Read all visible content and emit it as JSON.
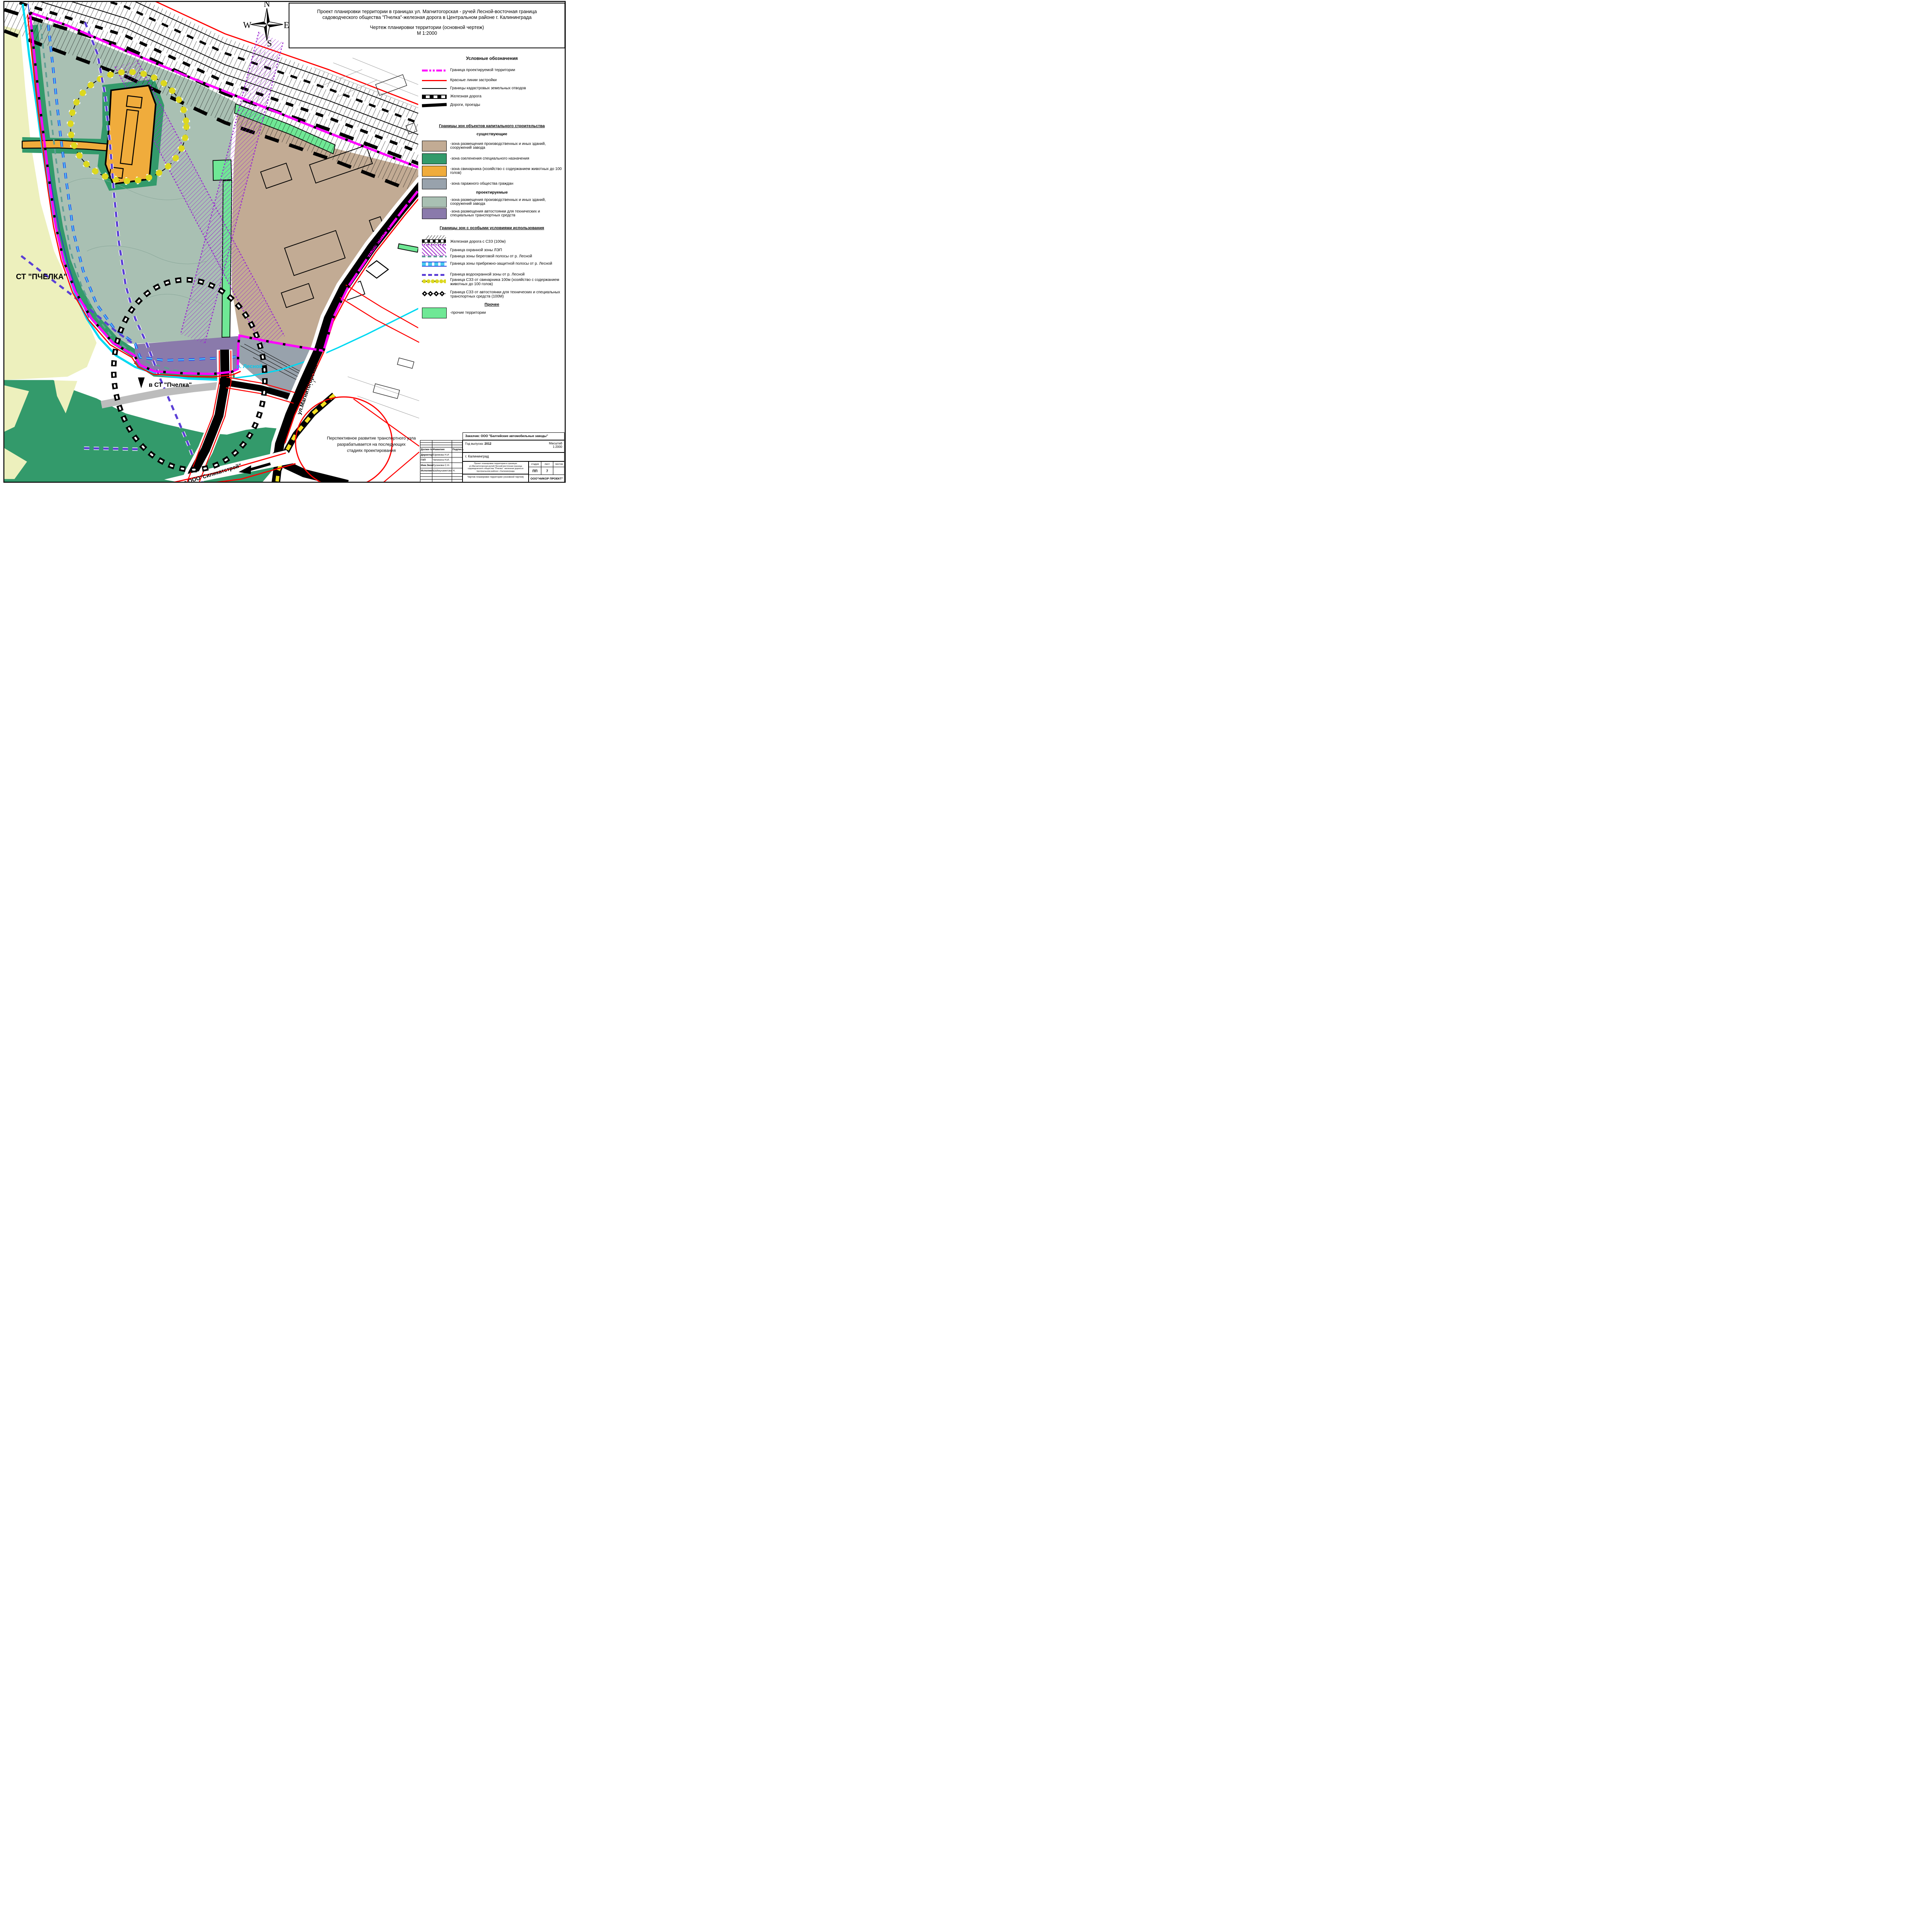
{
  "sheet_title": {
    "line1": "Проект планировки территории в границах ул. Магнитогорская - ручей Лесной-восточная граница",
    "line2": "садоводческого общества \"Пчелка\"-железная дорога в Центральном районе г. Калининграда",
    "line3": "Чертеж планировки территории (основной чертеж)",
    "line4": "М 1:2000"
  },
  "compass": {
    "n": "N",
    "w": "W",
    "e": "E",
    "s": "S"
  },
  "map_labels": {
    "st_pchelka": "СТ \"ПЧЕЛКА\"",
    "v_st_pchelka": "в СТ \"Пчелка\"",
    "r_lesnoy": "р. Лесной",
    "ul_magnitogorskaya_upper": "ул.Магнитогорская",
    "ul_magnitogorskaya_lower": "ул.Магнитогорская",
    "na_silikatstroy": "на ООО\"Силикатстрой\"",
    "note_line1": "Перспективное развитие транспортного узла",
    "note_line2": "разрабатывается на последующих",
    "note_line3": "стадиях проектирования"
  },
  "legend": {
    "header": "Условные обозначения",
    "lines": [
      {
        "label": "Граница проектируемой территории"
      },
      {
        "label": "Красные линии застройки"
      },
      {
        "label": "Границы кадастровых земельных отводов"
      },
      {
        "label": "Железная дорога"
      },
      {
        "label": "Дороги, проезды"
      }
    ],
    "capital_header": "Границы зон объектов капитального строительства",
    "existing_header": "существующие",
    "existing": [
      {
        "label": "-зона размещения производственных и иных зданий, сооружений завода",
        "color": "#c2ab94"
      },
      {
        "label": "-зона озеленения специального назначения",
        "color": "#339a6b"
      },
      {
        "label": "-зона свинарника (хозяйство с содержанием животных до 100 голов)",
        "color": "#f0ac3c"
      },
      {
        "label": "-зона гаражного общества граждан",
        "color": "#98a2ac"
      }
    ],
    "projected_header": "проектируемые",
    "projected": [
      {
        "label": "-зона размещения производственных и иных зданий, сооружений завода",
        "color": "#a9c0b3"
      },
      {
        "label": "-зона размещения автостоянки для технических и специальных транспортных средств",
        "color": "#8a7aab"
      }
    ],
    "special_header": "Границы зон с особыми условиями использования",
    "special": [
      {
        "label": "Железная дорога с СЗЗ (100м)"
      },
      {
        "label": "Граница охранной зоны ЛЭП"
      },
      {
        "label": "Граница зоны береговой полосы от р. Лесной"
      },
      {
        "label": "Граница зоны прибрежно-защитной полосы от р. Лесной"
      },
      {
        "label": "Граница водоохранной зоны от р. Лесной"
      },
      {
        "label": "Граница СЗЗ от свинарника 100м (хозяйство с содержанием животных до 100 голов)"
      },
      {
        "label": "Граница  СЗЗ от автостоянки для технических и специальных транспортных средств (100М)"
      }
    ],
    "other_header": "Прочее",
    "other": [
      {
        "label": "-прочие территории",
        "color": "#6fe895"
      }
    ]
  },
  "stamp": {
    "customer": "Заказчик:  ООО \"Балтийские автомобильные заводы\"",
    "year_label": "Год выпуска:",
    "year_value": "2012",
    "scale_label": "Масштаб",
    "scale_value": "1:2000",
    "city": "г. Калининград",
    "col_position": "Должн-ть",
    "col_name": "Фамилия",
    "col_sign": "Подпись",
    "rows": [
      {
        "position": "Директор",
        "name": "Ефимова Н.И"
      },
      {
        "position": "ГАП",
        "name": "Чепинога Н.И."
      },
      {
        "position": "Инж.Экон.",
        "name": "Русанова С.Н."
      },
      {
        "position": "Исполнил",
        "name": "Шаймухаметова Н."
      }
    ],
    "project_name": "Проект планировки территории в границах ул.Магнитогорская-ручей Лесной-восточная граница садоводческого общества \"Пчелка\" -железная дорога в Центральном районе г. Калининграда",
    "stage_label": "стадия",
    "sheet_label": "лист",
    "sheets_label": "листов",
    "stage_value": "ПП",
    "sheet_value": "7",
    "sheets_value": "",
    "drawing_name": "Чертеж планировки территории (основной чертеж)",
    "org": "ООО\"НИКОР ПРОЕКТ\""
  }
}
